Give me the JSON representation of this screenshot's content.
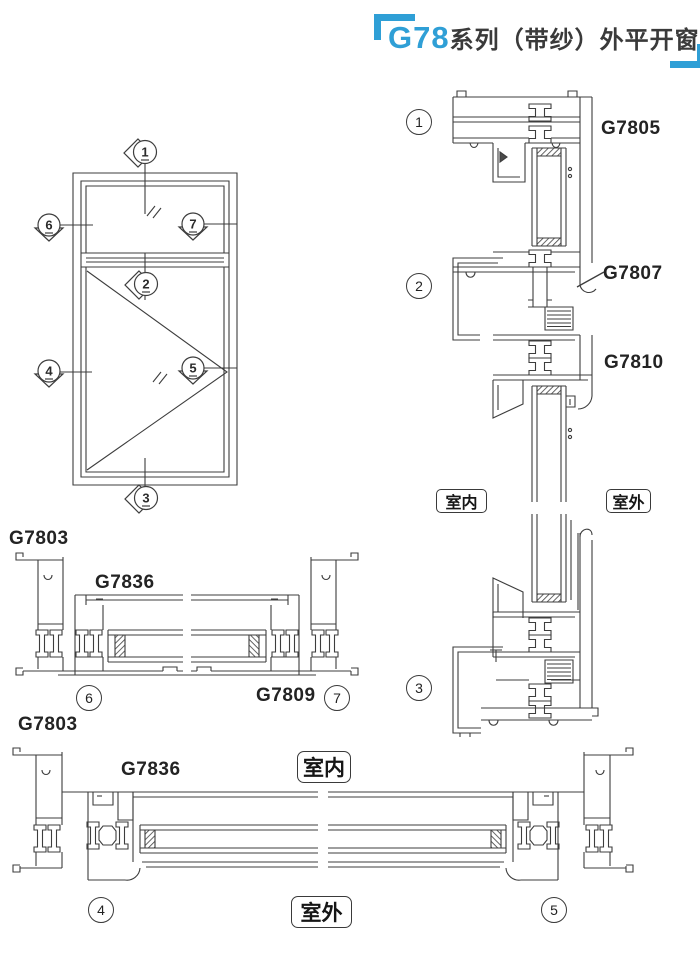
{
  "title": {
    "series": "G78",
    "suffix": "系列（带纱）外平开窗组装图"
  },
  "colors": {
    "accent": "#2f9fd6",
    "ink": "#3a3a3a",
    "line": "#3d3d3d"
  },
  "profile_labels": {
    "g7805": "G7805",
    "g7807": "G7807",
    "g7810": "G7810",
    "g7803_mid": "G7803",
    "g7836_mid": "G7836",
    "g7809": "G7809",
    "g7803_bottom": "G7803",
    "g7836_bottom": "G7836"
  },
  "room_labels": {
    "indoor_right": "室内",
    "outdoor_right": "室外",
    "indoor_bottom": "室内",
    "outdoor_bottom": "室外"
  },
  "elevation_markers": {
    "m1": "1",
    "m2": "2",
    "m3": "3",
    "m4": "4",
    "m5": "5",
    "m6": "6",
    "m7": "7"
  },
  "section_markers": {
    "s1": "1",
    "s2": "2",
    "s3": "3",
    "s4": "4",
    "s5": "5",
    "s6": "6",
    "s7": "7"
  }
}
